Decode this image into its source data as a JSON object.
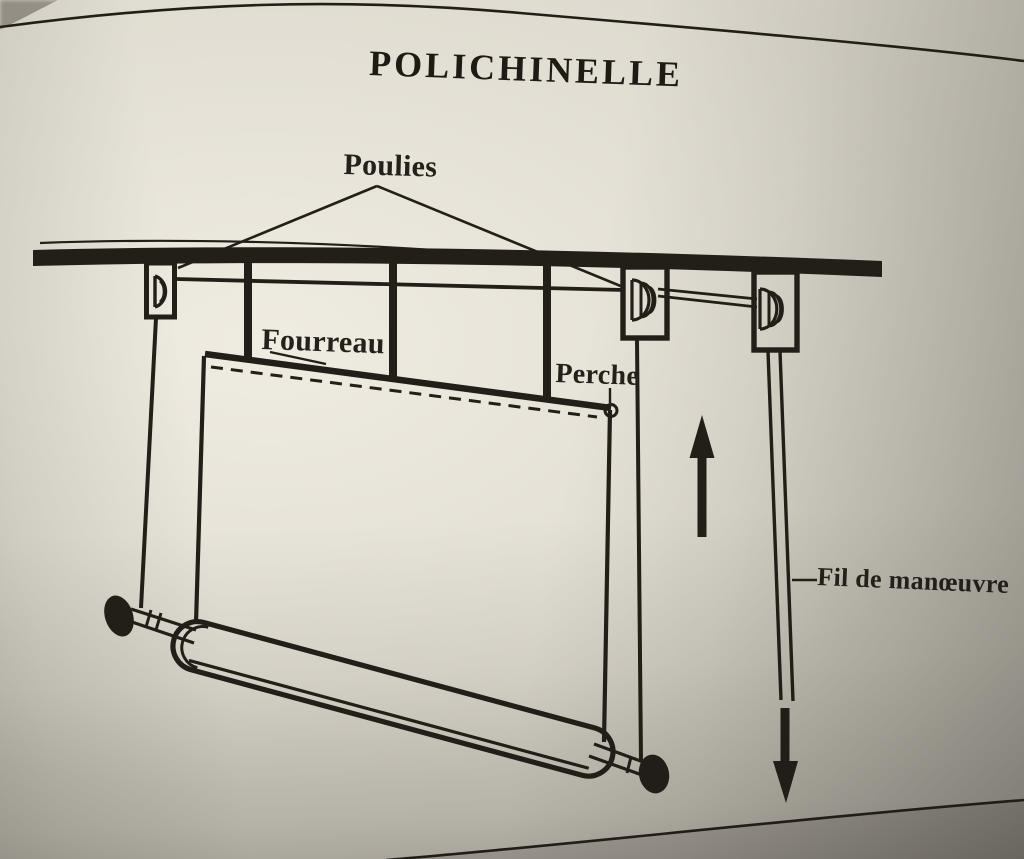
{
  "title": "POLICHINELLE",
  "labels": {
    "poulies": "Poulies",
    "fourreau": "Fourreau",
    "perche": "Perche",
    "fil_de_manoeuvre": "Fil de manœuvre"
  },
  "icons": {
    "up_arrow": "up-arrow-icon",
    "down_arrow": "down-arrow-icon"
  },
  "colors": {
    "ink": "#221e18",
    "paper": "#dcd8cd"
  }
}
